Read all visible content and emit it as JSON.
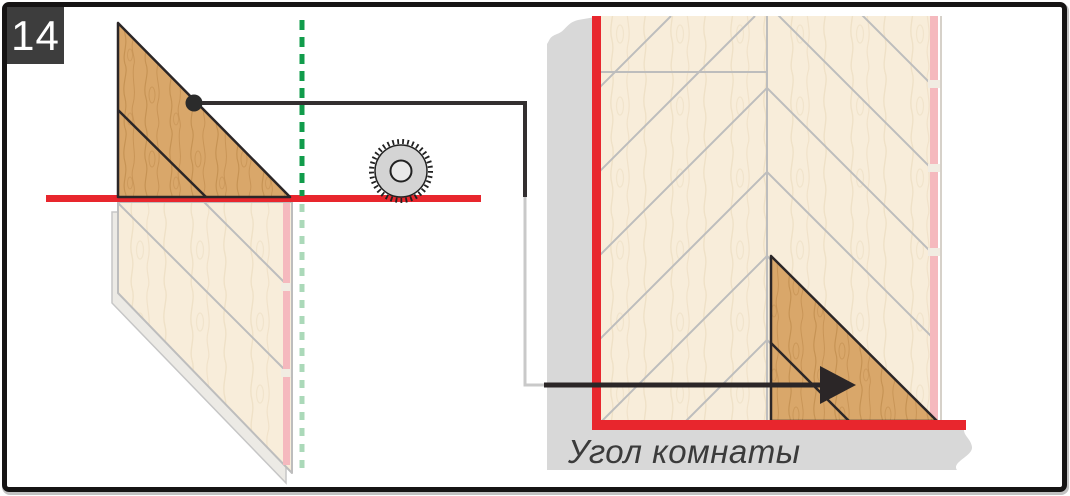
{
  "figure": {
    "step_number": "14",
    "caption": "Угол комнаты"
  },
  "icons": {
    "saw_blade": "circular-saw-blade-icon",
    "arrow": "placement-arrow-icon",
    "marker_dot": "leader-dot-icon"
  },
  "colors": {
    "guide_red": "#e8262d",
    "cut_line_green": "#119c4b",
    "cut_line_green_faded": "#abd9b9",
    "wood_fill": "#d9a76a",
    "wood_grain": "#c28e4f",
    "plank_cream": "#f8edda",
    "plank_cream_grain": "#efe0c6",
    "seam_gray": "#bdbdbd",
    "wall_gray": "#d8d8d8",
    "edge_pink": "#f5b9be",
    "outline_dark": "#2b2627",
    "leader_gray": "#c9c9c9",
    "badge_bg": "#3d3d3d",
    "badge_text": "#ffffff",
    "caption_text": "#3b3b3b",
    "saw_fill": "#d4d4d4"
  }
}
